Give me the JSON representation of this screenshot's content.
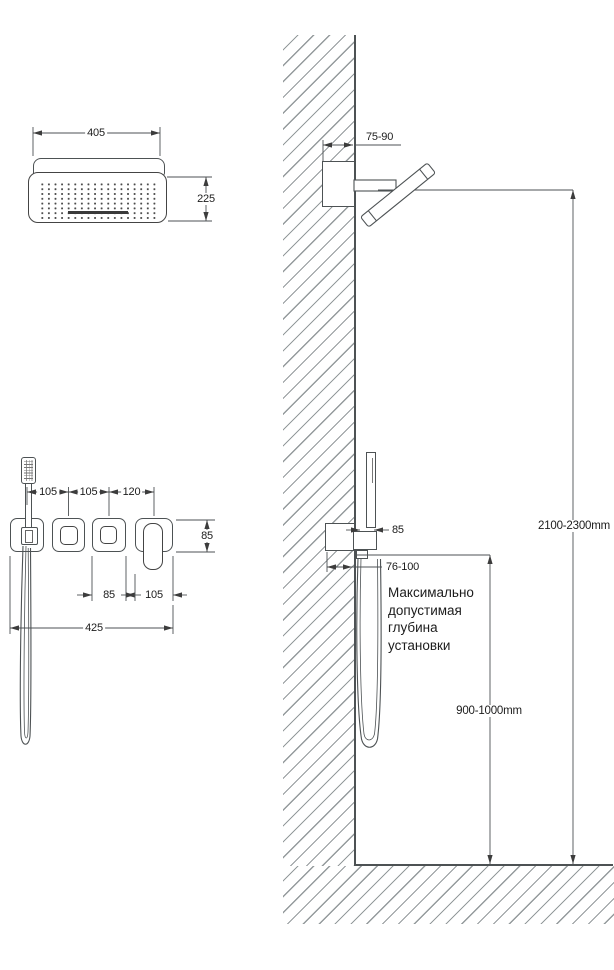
{
  "drawing": {
    "top_view": {
      "width_label": "405",
      "depth_label": "225"
    },
    "panel_view": {
      "spacing_1": "105",
      "spacing_2": "105",
      "spacing_3": "120",
      "module_height": "85",
      "knob_width": "85",
      "lever_width": "105",
      "total_width": "425"
    },
    "wall_section": {
      "head_box_depth": "75-90",
      "holder_depth": "85",
      "mixer_box_depth": "76-100",
      "shower_height": "2100-2300mm",
      "mixer_height": "900-1000mm",
      "note_lines": [
        "Максимально",
        "допустимая",
        "глубина",
        "установки"
      ]
    }
  }
}
